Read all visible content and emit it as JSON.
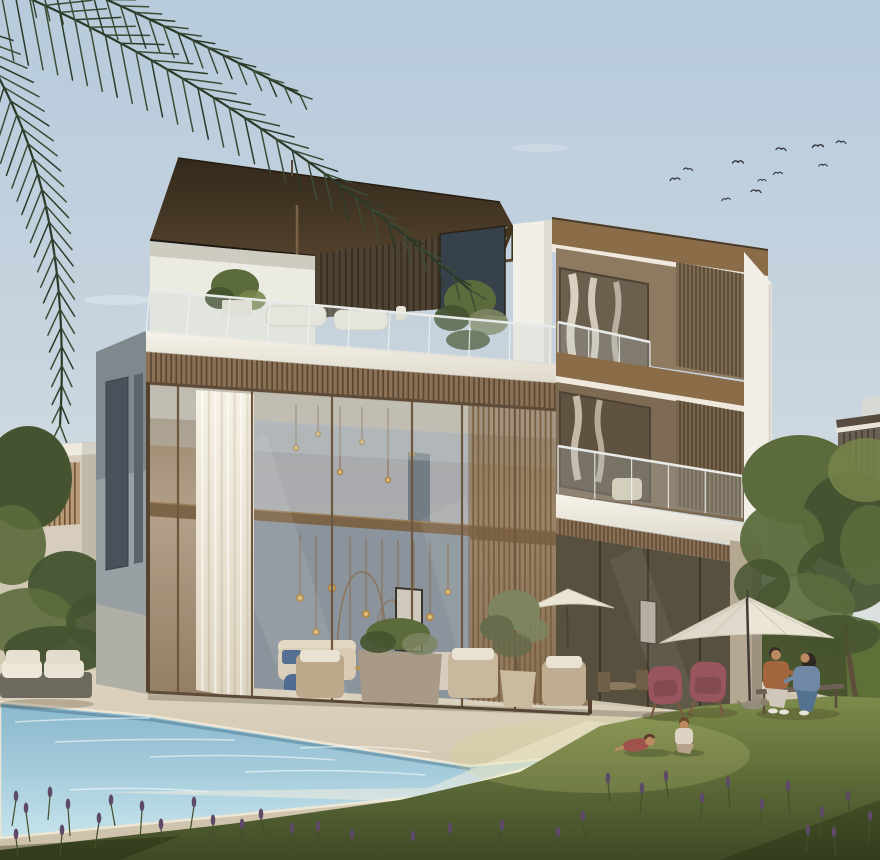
{
  "meta": {
    "title": "Architectural rendering of a modern three-storey villa with pool, lawn and garden at golden hour",
    "type": "photorealistic architectural exterior render",
    "canvas": {
      "width": 880,
      "height": 860
    }
  },
  "palette": {
    "skyTop": "#b7cbdc",
    "skyMid": "#c9d5df",
    "skyLow": "#dde2e0",
    "skyHorizon": "#e9e8e3",
    "roofDark": "#3a2e1f",
    "roofMid": "#5a472f",
    "soffit": "#8a6c49",
    "roofEdgeWhite": "#efe9dd",
    "wood": "#8a7156",
    "woodDark": "#5b4732",
    "woodLight": "#a58a68",
    "whiteBand": "#f2efe6",
    "whiteShade": "#d9d3c5",
    "wallBlue": "#8b949c",
    "wallBlueLight": "#a8adb2",
    "ceil": "#c9c2b4",
    "sideWall": "#98a0a4",
    "sideWallDark": "#49525a",
    "pillar": "#b5a893",
    "interiorRW": "#57503f",
    "gold": "#c79a55",
    "deckSun": "#f6efdf",
    "lavender": "#5d4a66",
    "lavStem": "#424f2a",
    "tree": "#5c6b3c",
    "treeDark": "#455330",
    "treeLight": "#76854a",
    "olive": "#7d8560",
    "oliveDark": "#646c4b",
    "hedge": "#49552e",
    "hedgeLight": "#5d7038",
    "umbrella": "#ebe5d6",
    "chairMaroon": "#98555e",
    "skin": "#bb8a60",
    "manShirt": "#a3653e",
    "womanTop": "#7188a6",
    "denim": "#547190",
    "benchWood": "#6b6255",
    "neighbor": "#d6cdbc",
    "palm": "#3c4c36",
    "palmDark": "#2c3a29",
    "bird": "#34353b"
  },
  "scene": {
    "objects": [
      "three-storey modern villa with bronze glass curtain wall",
      "flat dark-wood cantilevered roof with slatted pergola",
      "rooftop terrace with glass balustrade, plants and white lounge cushions",
      "vertical timber-slat privacy screens on each floor",
      "double-height living room with gold pendant lights and white curtain",
      "second-floor balcony with glass railing and armchair",
      "swimming pool with stone coping",
      "sunlit lawn with purple lavender sprigs",
      "patio with white parasols, two maroon wing chairs, couple on a bench, dog",
      "two children playing on the grass",
      "palm fronds in top-left corner, flock of birds in sky",
      "neighbouring beige villas and large green tree on the right"
    ],
    "people": {
      "adults_on_bench": [
        {
          "description": "man, rust-brown shirt, light trousers"
        },
        {
          "description": "woman, blue top, denim jeans, long dark hair"
        }
      ],
      "children_on_lawn": 2,
      "dog": 1
    },
    "birds": [
      [
        675,
        180,
        1,
        -6
      ],
      [
        688,
        170,
        0.9,
        8
      ],
      [
        738,
        163,
        1.1,
        0
      ],
      [
        726,
        200,
        0.85,
        -10
      ],
      [
        756,
        192,
        1,
        6
      ],
      [
        762,
        181,
        0.8,
        0
      ],
      [
        778,
        174,
        0.9,
        -5
      ],
      [
        781,
        150,
        1,
        6
      ],
      [
        818,
        147,
        1.1,
        -4
      ],
      [
        823,
        166,
        0.85,
        0
      ],
      [
        841,
        143,
        0.95,
        5
      ]
    ],
    "palm_fronds": [
      {
        "p0": [
          -15,
          -20
        ],
        "p1": [
          215,
          70
        ],
        "p2": [
          470,
          290
        ],
        "n": 32,
        "len0": 58,
        "len1": 16,
        "spread0": 0.95,
        "spread1": 0.5
      },
      {
        "p0": [
          -35,
          25
        ],
        "p1": [
          75,
          170
        ],
        "p2": [
          60,
          425
        ],
        "n": 26,
        "len0": 48,
        "len1": 14,
        "spread0": 0.95,
        "spread1": 0.55
      },
      {
        "p0": [
          25,
          -35
        ],
        "p1": [
          150,
          15
        ],
        "p2": [
          300,
          95
        ],
        "n": 20,
        "len0": 40,
        "len1": 12,
        "spread0": 0.9,
        "spread1": 0.5
      }
    ],
    "pergola": {
      "quad": [
        [
          315,
          256
        ],
        [
          513,
          226
        ],
        [
          513,
          260
        ],
        [
          332,
          282
        ]
      ],
      "n": 14,
      "color": "#43351f",
      "lw": 3.2
    },
    "slat_bands": [
      {
        "id": "g-neighborSlats",
        "quad": [
          [
            24,
            466
          ],
          [
            80,
            462
          ],
          [
            80,
            524
          ],
          [
            24,
            528
          ]
        ],
        "step": 5,
        "bg": "#b99b78",
        "line": "#6e5135",
        "lw": 1.6
      },
      {
        "id": "g-nrSlats",
        "quad": [
          [
            838,
            434
          ],
          [
            880,
            428
          ],
          [
            880,
            492
          ],
          [
            838,
            498
          ]
        ],
        "step": 6,
        "bg": "#6a6152",
        "line": "#4b443a",
        "lw": 2
      },
      {
        "id": "g-pergolaWall",
        "quad": [
          [
            315,
            254
          ],
          [
            500,
            228
          ],
          [
            500,
            305
          ],
          [
            315,
            318
          ]
        ],
        "step": 6,
        "bg": "#4e4232",
        "line": "#382d20",
        "lw": 1.8
      },
      {
        "id": "g-fasciaBand",
        "quad": [
          [
            146,
            352
          ],
          [
            590,
            386
          ],
          [
            590,
            412
          ],
          [
            146,
            383
          ]
        ],
        "step": 5,
        "bg": "#8a7156",
        "line": "#5b4732",
        "lw": 1.7
      },
      {
        "id": "g-glassScreen",
        "quad": [
          [
            468,
            404
          ],
          [
            556,
            410
          ],
          [
            556,
            706
          ],
          [
            468,
            700
          ]
        ],
        "step": 5,
        "bg": "rgba(125,97,66,0.45)",
        "line": "#7a5f41",
        "lw": 1.8
      },
      {
        "id": "g-rw3Screen",
        "quad": [
          [
            676,
            262
          ],
          [
            744,
            274
          ],
          [
            744,
            378
          ],
          [
            676,
            366
          ]
        ],
        "step": 4,
        "bg": "#7d6a52",
        "line": "#55452f",
        "lw": 1.5
      },
      {
        "id": "g-rw2Screen",
        "quad": [
          [
            676,
            400
          ],
          [
            744,
            412
          ],
          [
            744,
            518
          ],
          [
            676,
            506
          ]
        ],
        "step": 4,
        "bg": "#76644d",
        "line": "#52422d",
        "lw": 1.5
      },
      {
        "id": "g-rwThinBand",
        "quad": [
          [
            556,
            518
          ],
          [
            744,
            548
          ],
          [
            744,
            564
          ],
          [
            556,
            534
          ]
        ],
        "step": 4,
        "bg": "#8a7156",
        "line": "#5b4732",
        "lw": 1.4
      }
    ],
    "mullions": {
      "id": "g-mullions",
      "top": [
        [
          148,
          383
        ],
        [
          590,
          412
        ]
      ],
      "bot": [
        [
          148,
          692
        ],
        [
          590,
          714
        ]
      ],
      "xs": [
        178,
        252,
        332,
        412,
        462,
        515
      ],
      "color": "#6e573f",
      "lw": 2.2
    },
    "rails": [
      {
        "id": "g-terraceRail",
        "top": [
          [
            150,
            290
          ],
          [
            590,
            330
          ]
        ],
        "bot": [
          [
            146,
            332
          ],
          [
            590,
            368
          ]
        ],
        "n": 11
      },
      {
        "id": "g-rail3",
        "top": [
          [
            558,
            322
          ],
          [
            650,
            342
          ]
        ],
        "bot": [
          [
            558,
            360
          ],
          [
            650,
            374
          ]
        ],
        "n": 3
      },
      {
        "id": "g-rail2",
        "top": [
          [
            558,
            446
          ],
          [
            742,
            476
          ]
        ],
        "bot": [
          [
            558,
            494
          ],
          [
            742,
            518
          ]
        ],
        "n": 5
      }
    ],
    "curtain_folds": {
      "id": "g-folds",
      "quad": [
        [
          196,
          390
        ],
        [
          254,
          394
        ],
        [
          254,
          700
        ],
        [
          196,
          690
        ]
      ],
      "step": 6
    },
    "pendants_upper": [
      [
        296,
        404,
        448,
        3.2
      ],
      [
        318,
        405,
        434,
        3
      ],
      [
        340,
        406,
        472,
        3.2
      ],
      [
        362,
        407,
        442,
        3
      ],
      [
        388,
        408,
        480,
        3.2
      ],
      [
        412,
        409,
        454,
        3
      ]
    ],
    "pendants_lower": [
      [
        300,
        534,
        598,
        4
      ],
      [
        316,
        535,
        632,
        3.6
      ],
      [
        332,
        536,
        588,
        4.2
      ],
      [
        350,
        537,
        652,
        3.6
      ],
      [
        366,
        538,
        614,
        4
      ],
      [
        382,
        539,
        664,
        3.4
      ],
      [
        398,
        540,
        602,
        4
      ],
      [
        414,
        541,
        642,
        3.6
      ],
      [
        430,
        542,
        617,
        4
      ],
      [
        448,
        543,
        592,
        3.4
      ]
    ],
    "foliage": [
      {
        "id": "g-bushesLeft",
        "items": [
          [
            28,
            478,
            44,
            52,
            "treeDark",
            1
          ],
          [
            12,
            545,
            34,
            40,
            "tree",
            0.92
          ],
          [
            68,
            585,
            40,
            34,
            "treeDark",
            0.95
          ],
          [
            28,
            622,
            48,
            34,
            "tree",
            0.9
          ],
          [
            100,
            622,
            34,
            28,
            "treeDark",
            0.9
          ],
          [
            130,
            602,
            24,
            20,
            "tree",
            0.8
          ],
          [
            58,
            650,
            54,
            24,
            "treeDark",
            0.95
          ],
          [
            120,
            645,
            30,
            18,
            "treeDark",
            0.85
          ]
        ]
      },
      {
        "id": "g-terracePlants",
        "items": [
          [
            235,
            286,
            24,
            17,
            "tree",
            1
          ],
          [
            220,
            298,
            15,
            11,
            "treeDark",
            1
          ],
          [
            252,
            300,
            14,
            10,
            "treeLight",
            0.9
          ],
          [
            470,
            300,
            26,
            20,
            "tree",
            1
          ],
          [
            452,
            318,
            18,
            13,
            "treeDark",
            0.95
          ],
          [
            488,
            322,
            20,
            13,
            "olive",
            0.9
          ],
          [
            468,
            340,
            22,
            10,
            "treeDark",
            0.9
          ]
        ]
      },
      {
        "id": "g-treeFoliage",
        "items": [
          [
            800,
            480,
            58,
            45,
            "tree",
            1
          ],
          [
            852,
            520,
            50,
            48,
            "treeDark",
            1
          ],
          [
            782,
            540,
            42,
            38,
            "tree",
            0.95
          ],
          [
            845,
            575,
            48,
            38,
            "treeDark",
            0.92
          ],
          [
            805,
            605,
            50,
            32,
            "tree",
            0.9
          ],
          [
            866,
            470,
            38,
            32,
            "treeLight",
            0.85
          ],
          [
            762,
            585,
            28,
            26,
            "treeDark",
            0.85
          ],
          [
            838,
            635,
            42,
            20,
            "treeDark",
            0.8
          ],
          [
            870,
            545,
            30,
            40,
            "tree",
            0.9
          ]
        ]
      },
      {
        "id": "g-hedgeBumps",
        "items": [
          [
            615,
            650,
            22,
            10,
            "hedge",
            1
          ],
          [
            655,
            642,
            24,
            10,
            "hedge",
            1
          ],
          [
            700,
            636,
            24,
            10,
            "hedge",
            1
          ],
          [
            745,
            631,
            24,
            10,
            "hedge",
            1
          ],
          [
            790,
            628,
            26,
            10,
            "hedge",
            1
          ],
          [
            835,
            626,
            26,
            11,
            "hedgeLight",
            0.9
          ],
          [
            866,
            632,
            20,
            12,
            "hedgeLight",
            0.95
          ]
        ]
      },
      {
        "id": "g-planterShrub",
        "items": [
          [
            398,
            634,
            32,
            16,
            "tree",
            1
          ],
          [
            378,
            642,
            18,
            11,
            "treeDark",
            0.9
          ],
          [
            420,
            644,
            18,
            11,
            "olive",
            0.85
          ]
        ]
      },
      {
        "id": "g-oliveFol",
        "items": [
          [
            514,
            610,
            26,
            20,
            "olive",
            1
          ],
          [
            497,
            628,
            17,
            13,
            "oliveDark",
            0.9
          ],
          [
            533,
            630,
            16,
            12,
            "olive",
            0.85
          ],
          [
            512,
            645,
            20,
            12,
            "oliveDark",
            0.8
          ]
        ]
      }
    ],
    "lavender": [
      [
        12,
        826,
        26,
        2
      ],
      [
        30,
        842,
        30,
        -2
      ],
      [
        48,
        820,
        24,
        1
      ],
      [
        70,
        836,
        28,
        -1
      ],
      [
        95,
        848,
        26,
        2
      ],
      [
        115,
        826,
        22,
        -2
      ],
      [
        140,
        840,
        30,
        1
      ],
      [
        163,
        852,
        24,
        -1
      ],
      [
        190,
        832,
        26,
        2
      ],
      [
        215,
        846,
        22,
        -1
      ],
      [
        240,
        854,
        26,
        1
      ],
      [
        265,
        838,
        20,
        -2
      ],
      [
        60,
        856,
        22,
        1
      ],
      [
        18,
        856,
        18,
        -1
      ],
      [
        290,
        850,
        18,
        1
      ],
      [
        320,
        846,
        16,
        -1
      ],
      [
        350,
        852,
        14,
        1
      ],
      [
        610,
        802,
        20,
        -1
      ],
      [
        640,
        814,
        22,
        1
      ],
      [
        668,
        798,
        18,
        -1
      ],
      [
        700,
        822,
        20,
        1
      ],
      [
        730,
        808,
        22,
        -1
      ],
      [
        760,
        828,
        20,
        1
      ],
      [
        790,
        814,
        24,
        -1
      ],
      [
        820,
        838,
        22,
        1
      ],
      [
        850,
        820,
        20,
        -1
      ],
      [
        868,
        844,
        24,
        1
      ],
      [
        836,
        856,
        20,
        -1
      ],
      [
        806,
        852,
        18,
        1
      ],
      [
        585,
        838,
        18,
        -1
      ],
      [
        556,
        852,
        16,
        1
      ],
      [
        452,
        846,
        14,
        -1
      ],
      [
        500,
        842,
        13,
        1
      ],
      [
        415,
        852,
        12,
        -1
      ]
    ],
    "water_lines": [
      [
        15,
        722,
        150,
        718
      ],
      [
        55,
        742,
        235,
        740
      ],
      [
        150,
        757,
        335,
        760
      ],
      [
        245,
        772,
        425,
        775
      ],
      [
        70,
        790,
        210,
        792
      ],
      [
        300,
        748,
        430,
        752
      ]
    ]
  }
}
